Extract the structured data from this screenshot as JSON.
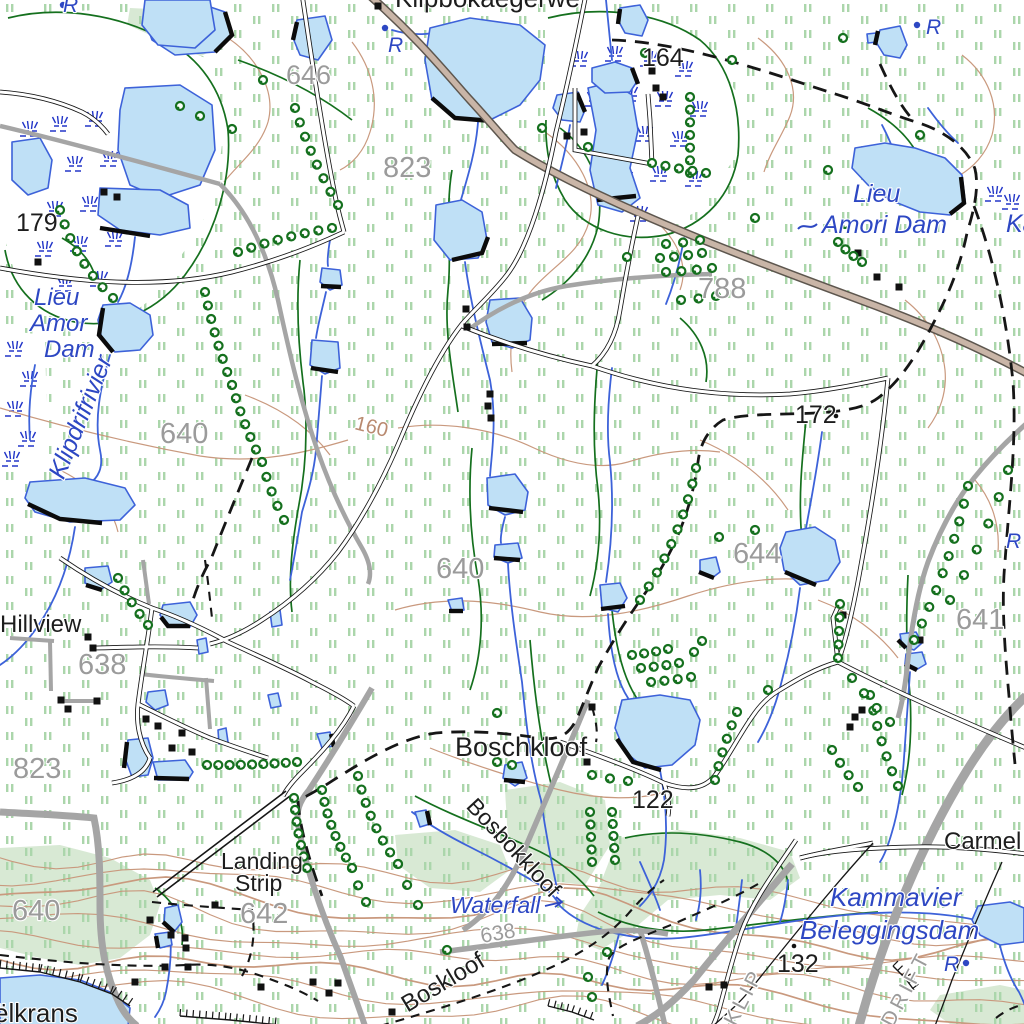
{
  "map": {
    "type": "topographic",
    "palette": {
      "water_fill": "#bfe0f6",
      "water_line": "#3d62d9",
      "marsh_blue": "#2336c8",
      "vegetation_dash": "#abd6ab",
      "woodland": "#d8e9d4",
      "contour": "#c9997e",
      "road_major_fill": "#c9b5a7",
      "road_major_casing": "#5d564e",
      "road_gray": "#a5a5a5",
      "ink": "#141414",
      "tree_green": "#15701e",
      "label_black": "#1d1d1d",
      "label_gray": "#9b9b9b",
      "label_blue": "#2d47c3",
      "label_contour": "#b98a70"
    },
    "labels": {
      "top_farm": "Klipbokaegerwe",
      "r_top1": "R",
      "r_top2": "R",
      "r_topright": "R",
      "r_mid": "R",
      "r_bottom": "R",
      "h646": "646",
      "h823a": "823",
      "h164": "164",
      "h788": "788",
      "h179": "179",
      "lieu1": "Lieu",
      "lieu2": "Amor",
      "lieu3": "Dam",
      "klipdrifrivier": "Klipdrifrivier",
      "h640a": "640",
      "c160": "160",
      "h640b": "640",
      "h638": "638",
      "hillview": "Hillview",
      "h823b": "823",
      "h172": "172",
      "h644": "644",
      "h641": "641",
      "amori1": "Lieu",
      "amori2": "Amori Dam",
      "ka": "Ka",
      "boschkloof": "Boschkloof",
      "h122": "122",
      "landing1": "Landing",
      "landing2": "Strip",
      "h642": "642",
      "bosbokkloof": "Bosbokkloof",
      "waterfall": "Waterfall",
      "c638": "638",
      "boskloof": "Boskloof",
      "elkrans": "ëlkrans",
      "carmel": "Carmel",
      "kammavier": "Kammavier",
      "beleggingsdam": "Beleggingsdam",
      "h132": "132",
      "klip": "KLIP",
      "drift": "DRIFT",
      "h640c": "640"
    }
  }
}
